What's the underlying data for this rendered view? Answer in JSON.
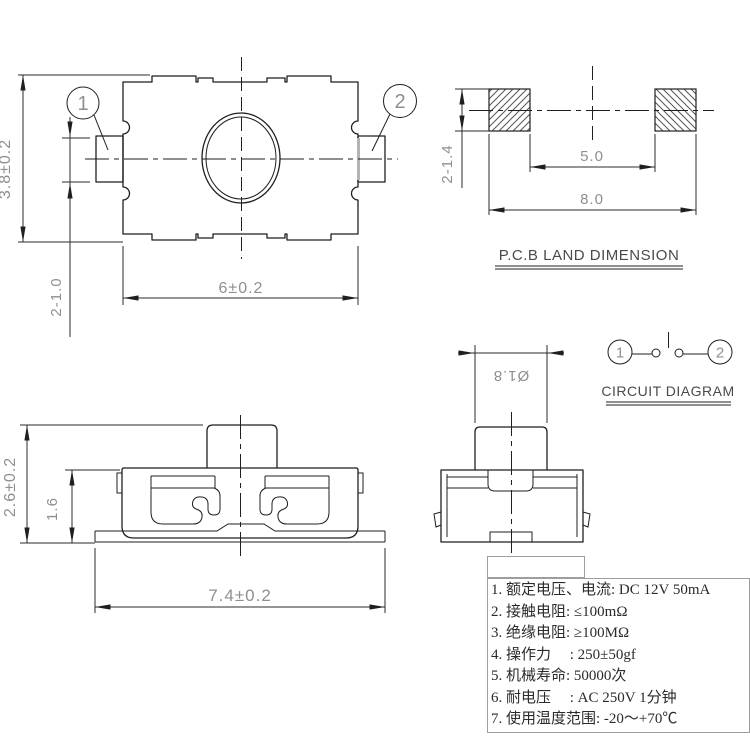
{
  "top_view": {
    "height": "3.8±0.2",
    "pad_width": "2-1.0",
    "body_width": "6±0.2",
    "callout_1": "1",
    "callout_2": "2"
  },
  "pcb_land": {
    "title": "P.C.B LAND DIMENSION",
    "pad_size": "2-1.4",
    "pitch_inner": "5.0",
    "pitch_outer": "8.0"
  },
  "circuit": {
    "title": "CIRCUIT DIAGRAM",
    "terminal_1": "1",
    "terminal_2": "2"
  },
  "front_view": {
    "total_height": "2.6±0.2",
    "body_height": "1.6",
    "base_width": "7.4±0.2"
  },
  "end_view": {
    "button_diameter": "Ø1.8"
  },
  "specs": {
    "title": "技术参数:",
    "items": [
      "1. 额定电压、电流: DC 12V 50mA",
      "2. 接触电阻: ≤100mΩ",
      "3. 绝缘电阻: ≥100MΩ",
      "4. 操作力　 : 250±50gf",
      "5. 机械寿命: 50000次",
      "6. 耐电压　 : AC 250V 1分钟",
      "7. 使用温度范围: -20～+70℃"
    ]
  }
}
